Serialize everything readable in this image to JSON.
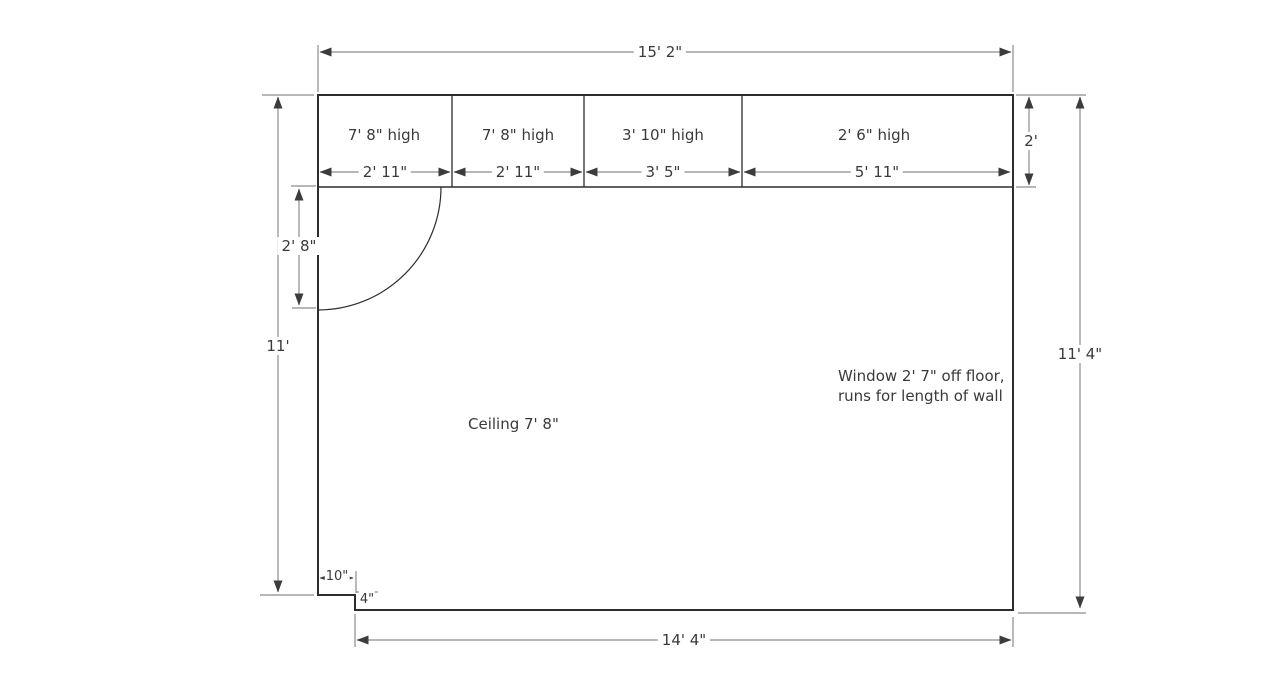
{
  "diagram": {
    "title": "room-floor-plan",
    "dim_top": "15' 2\"",
    "dim_bottom": "14' 4\"",
    "dim_left": "11'",
    "dim_right": "11' 4\"",
    "dim_right_top": "2'",
    "dim_door_opening": "2' 8\"",
    "dim_notch_width": "10\"",
    "dim_notch_height": "4\"",
    "cabinets": [
      {
        "height": "7' 8\" high",
        "width": "2' 11\""
      },
      {
        "height": "7' 8\" high",
        "width": "2' 11\""
      },
      {
        "height": "3' 10\" high",
        "width": "3' 5\""
      },
      {
        "height": "2' 6\" high",
        "width": "5' 11\""
      }
    ],
    "ceiling_note": "Ceiling 7' 8\"",
    "window_note_line1": "Window 2' 7\" off floor,",
    "window_note_line2": "runs for length of wall",
    "colors": {
      "wall": "#2d2d2d",
      "dimension_line": "#8c8c8c",
      "arrow": "#3c3c3c",
      "text": "#3a3a3a"
    }
  }
}
